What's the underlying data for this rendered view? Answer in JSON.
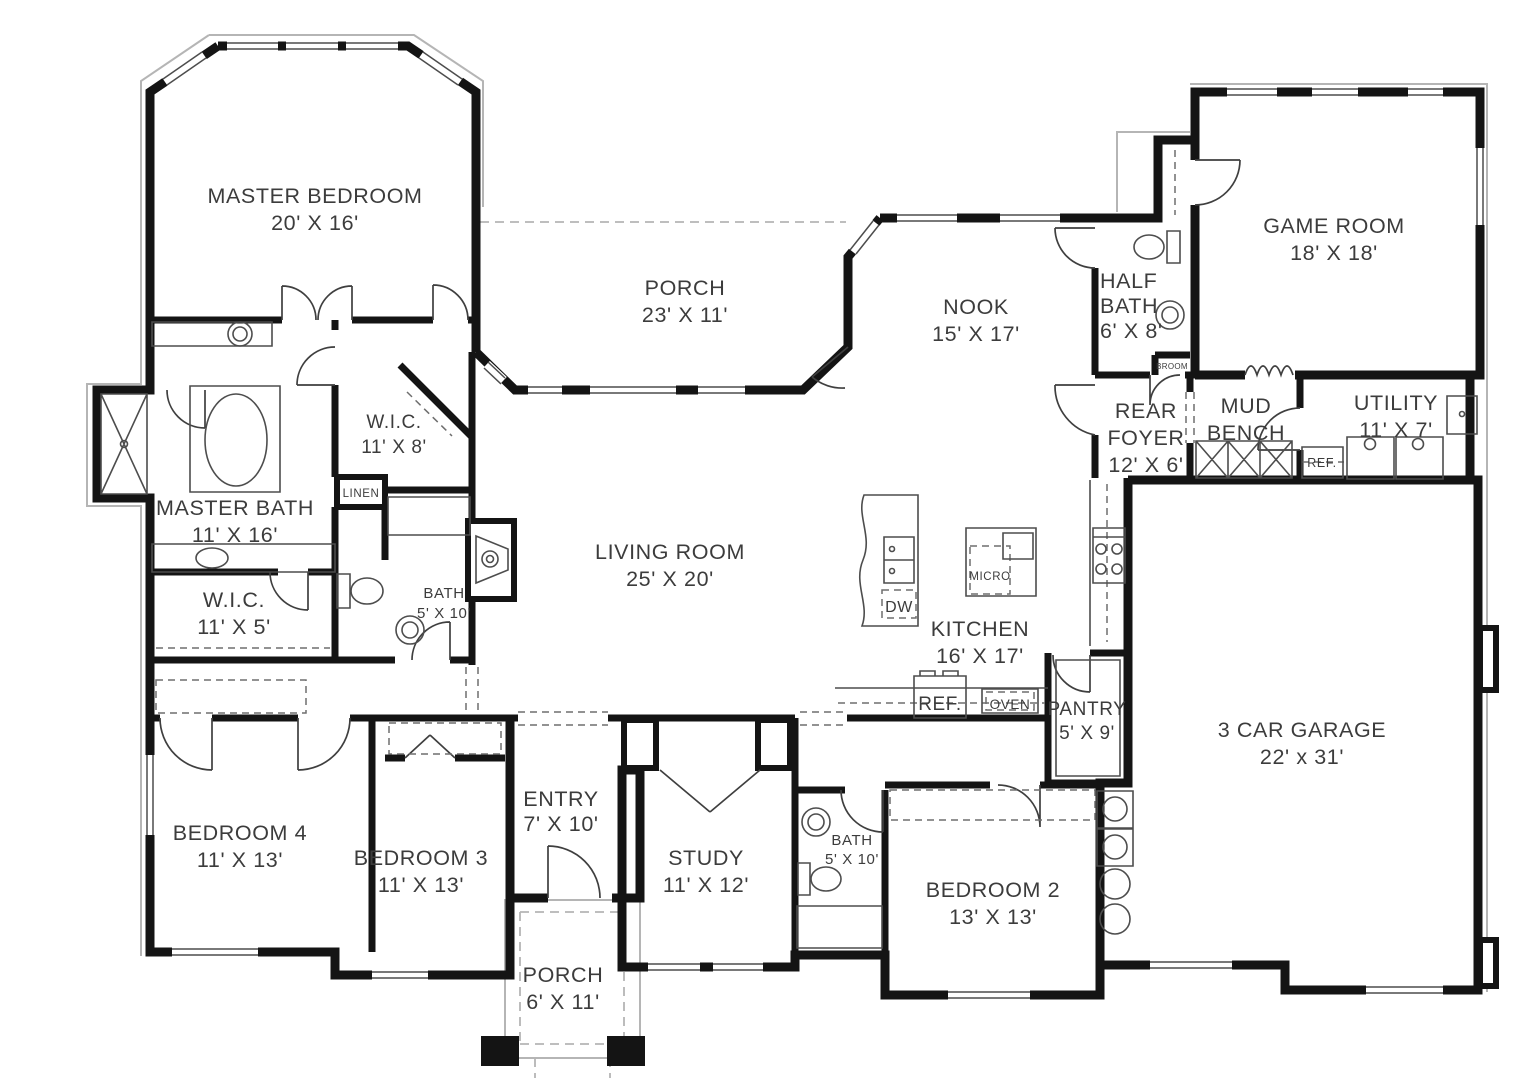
{
  "meta": {
    "kind": "architectural-floor-plan"
  },
  "colors": {
    "wall": "#141414",
    "fixture": "#4d4d4d",
    "light_line": "#b5b5b5",
    "dashed_line": "#6e6e6e",
    "label_text": "#3c3c3c",
    "background": "#ffffff"
  },
  "plan": {
    "rooms": [
      {
        "id": "master-bedroom",
        "lines": [
          "MASTER BEDROOM",
          "20' X 16'"
        ]
      },
      {
        "id": "porch-rear",
        "lines": [
          "PORCH",
          "23' X 11'"
        ]
      },
      {
        "id": "nook",
        "lines": [
          "NOOK",
          "15' X 17'"
        ]
      },
      {
        "id": "half-bath",
        "lines": [
          "HALF",
          "BATH",
          "6' X 8'"
        ]
      },
      {
        "id": "game-room",
        "lines": [
          "GAME ROOM",
          "18' X 18'"
        ]
      },
      {
        "id": "rear-foyer",
        "lines": [
          "REAR",
          "FOYER",
          "12' X 6'"
        ]
      },
      {
        "id": "mud-bench",
        "lines": [
          "MUD",
          "BENCH"
        ]
      },
      {
        "id": "utility",
        "lines": [
          "UTILITY",
          "11' X 7'"
        ]
      },
      {
        "id": "living-room",
        "lines": [
          "LIVING ROOM",
          "25' X 20'"
        ]
      },
      {
        "id": "kitchen",
        "lines": [
          "KITCHEN",
          "16' X 17'"
        ]
      },
      {
        "id": "master-bath",
        "lines": [
          "MASTER BATH",
          "11' X 16'"
        ]
      },
      {
        "id": "wic-master-5",
        "lines": [
          "W.I.C.",
          "11' X 5'"
        ]
      },
      {
        "id": "wic-master-8",
        "lines": [
          "W.I.C.",
          "11' X 8'"
        ]
      },
      {
        "id": "bath-hall",
        "lines": [
          "BATH",
          "5' X 10'"
        ]
      },
      {
        "id": "pantry",
        "lines": [
          "PANTRY",
          "5' X 9'"
        ]
      },
      {
        "id": "garage",
        "lines": [
          "3 CAR GARAGE",
          "22' x 31'"
        ]
      },
      {
        "id": "bedroom-4",
        "lines": [
          "BEDROOM 4",
          "11' X 13'"
        ]
      },
      {
        "id": "bedroom-3",
        "lines": [
          "BEDROOM 3",
          "11' X 13'"
        ]
      },
      {
        "id": "entry",
        "lines": [
          "ENTRY",
          "7' X 10'"
        ]
      },
      {
        "id": "study",
        "lines": [
          "STUDY",
          "11' X 12'"
        ]
      },
      {
        "id": "bath-2",
        "lines": [
          "BATH",
          "5' X 10'"
        ]
      },
      {
        "id": "bedroom-2",
        "lines": [
          "BEDROOM 2",
          "13' X 13'"
        ]
      },
      {
        "id": "porch-front",
        "lines": [
          "PORCH",
          "6' X 11'"
        ]
      }
    ],
    "small_labels": {
      "linen": "LINEN",
      "broom": "BROOM",
      "dishwasher": "DW",
      "microwave": "MICRO",
      "refrigerator_kitchen": "REF.",
      "oven": "OVEN",
      "refrigerator_utility": "REF."
    }
  }
}
